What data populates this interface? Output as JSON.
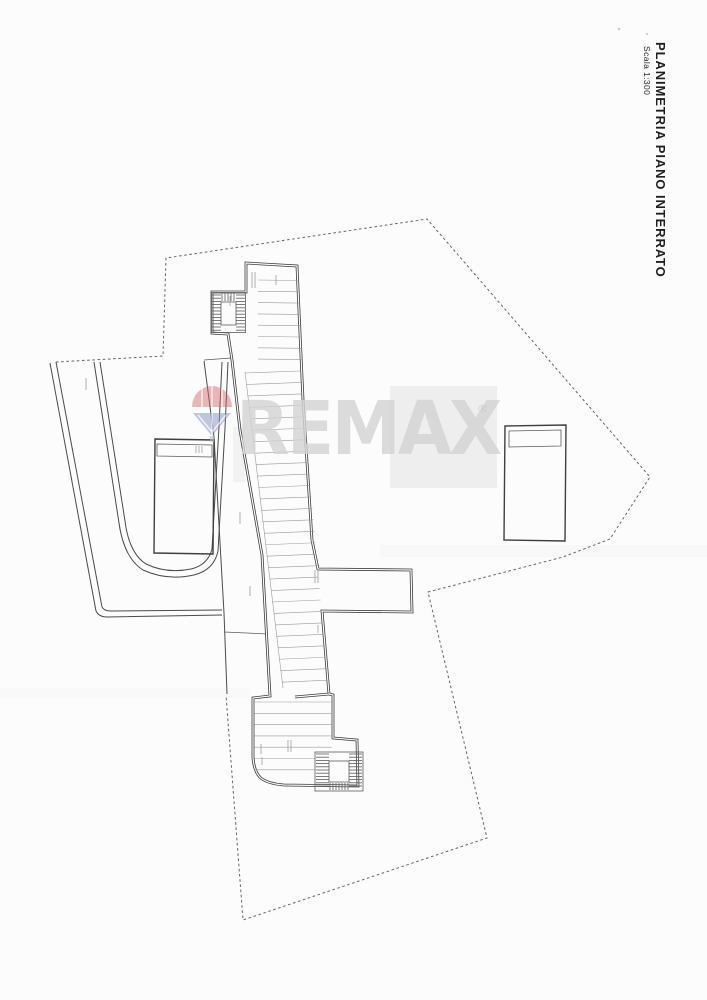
{
  "document": {
    "title": "PLANIMETRIA PIANO INTERRATO",
    "scale_label": "Scala 1:300"
  },
  "watermark": {
    "brand_text": "REMAX",
    "registered_symbol": "®"
  },
  "colors": {
    "paper": "#fcfcfc",
    "plan_line": "#3b3b3b",
    "thin_line": "#9a9a9a",
    "boundary_dash": "#666666",
    "watermark_text": "#d4d4d4",
    "balloon_red": "#d4646c",
    "balloon_blue": "#8095c0"
  }
}
